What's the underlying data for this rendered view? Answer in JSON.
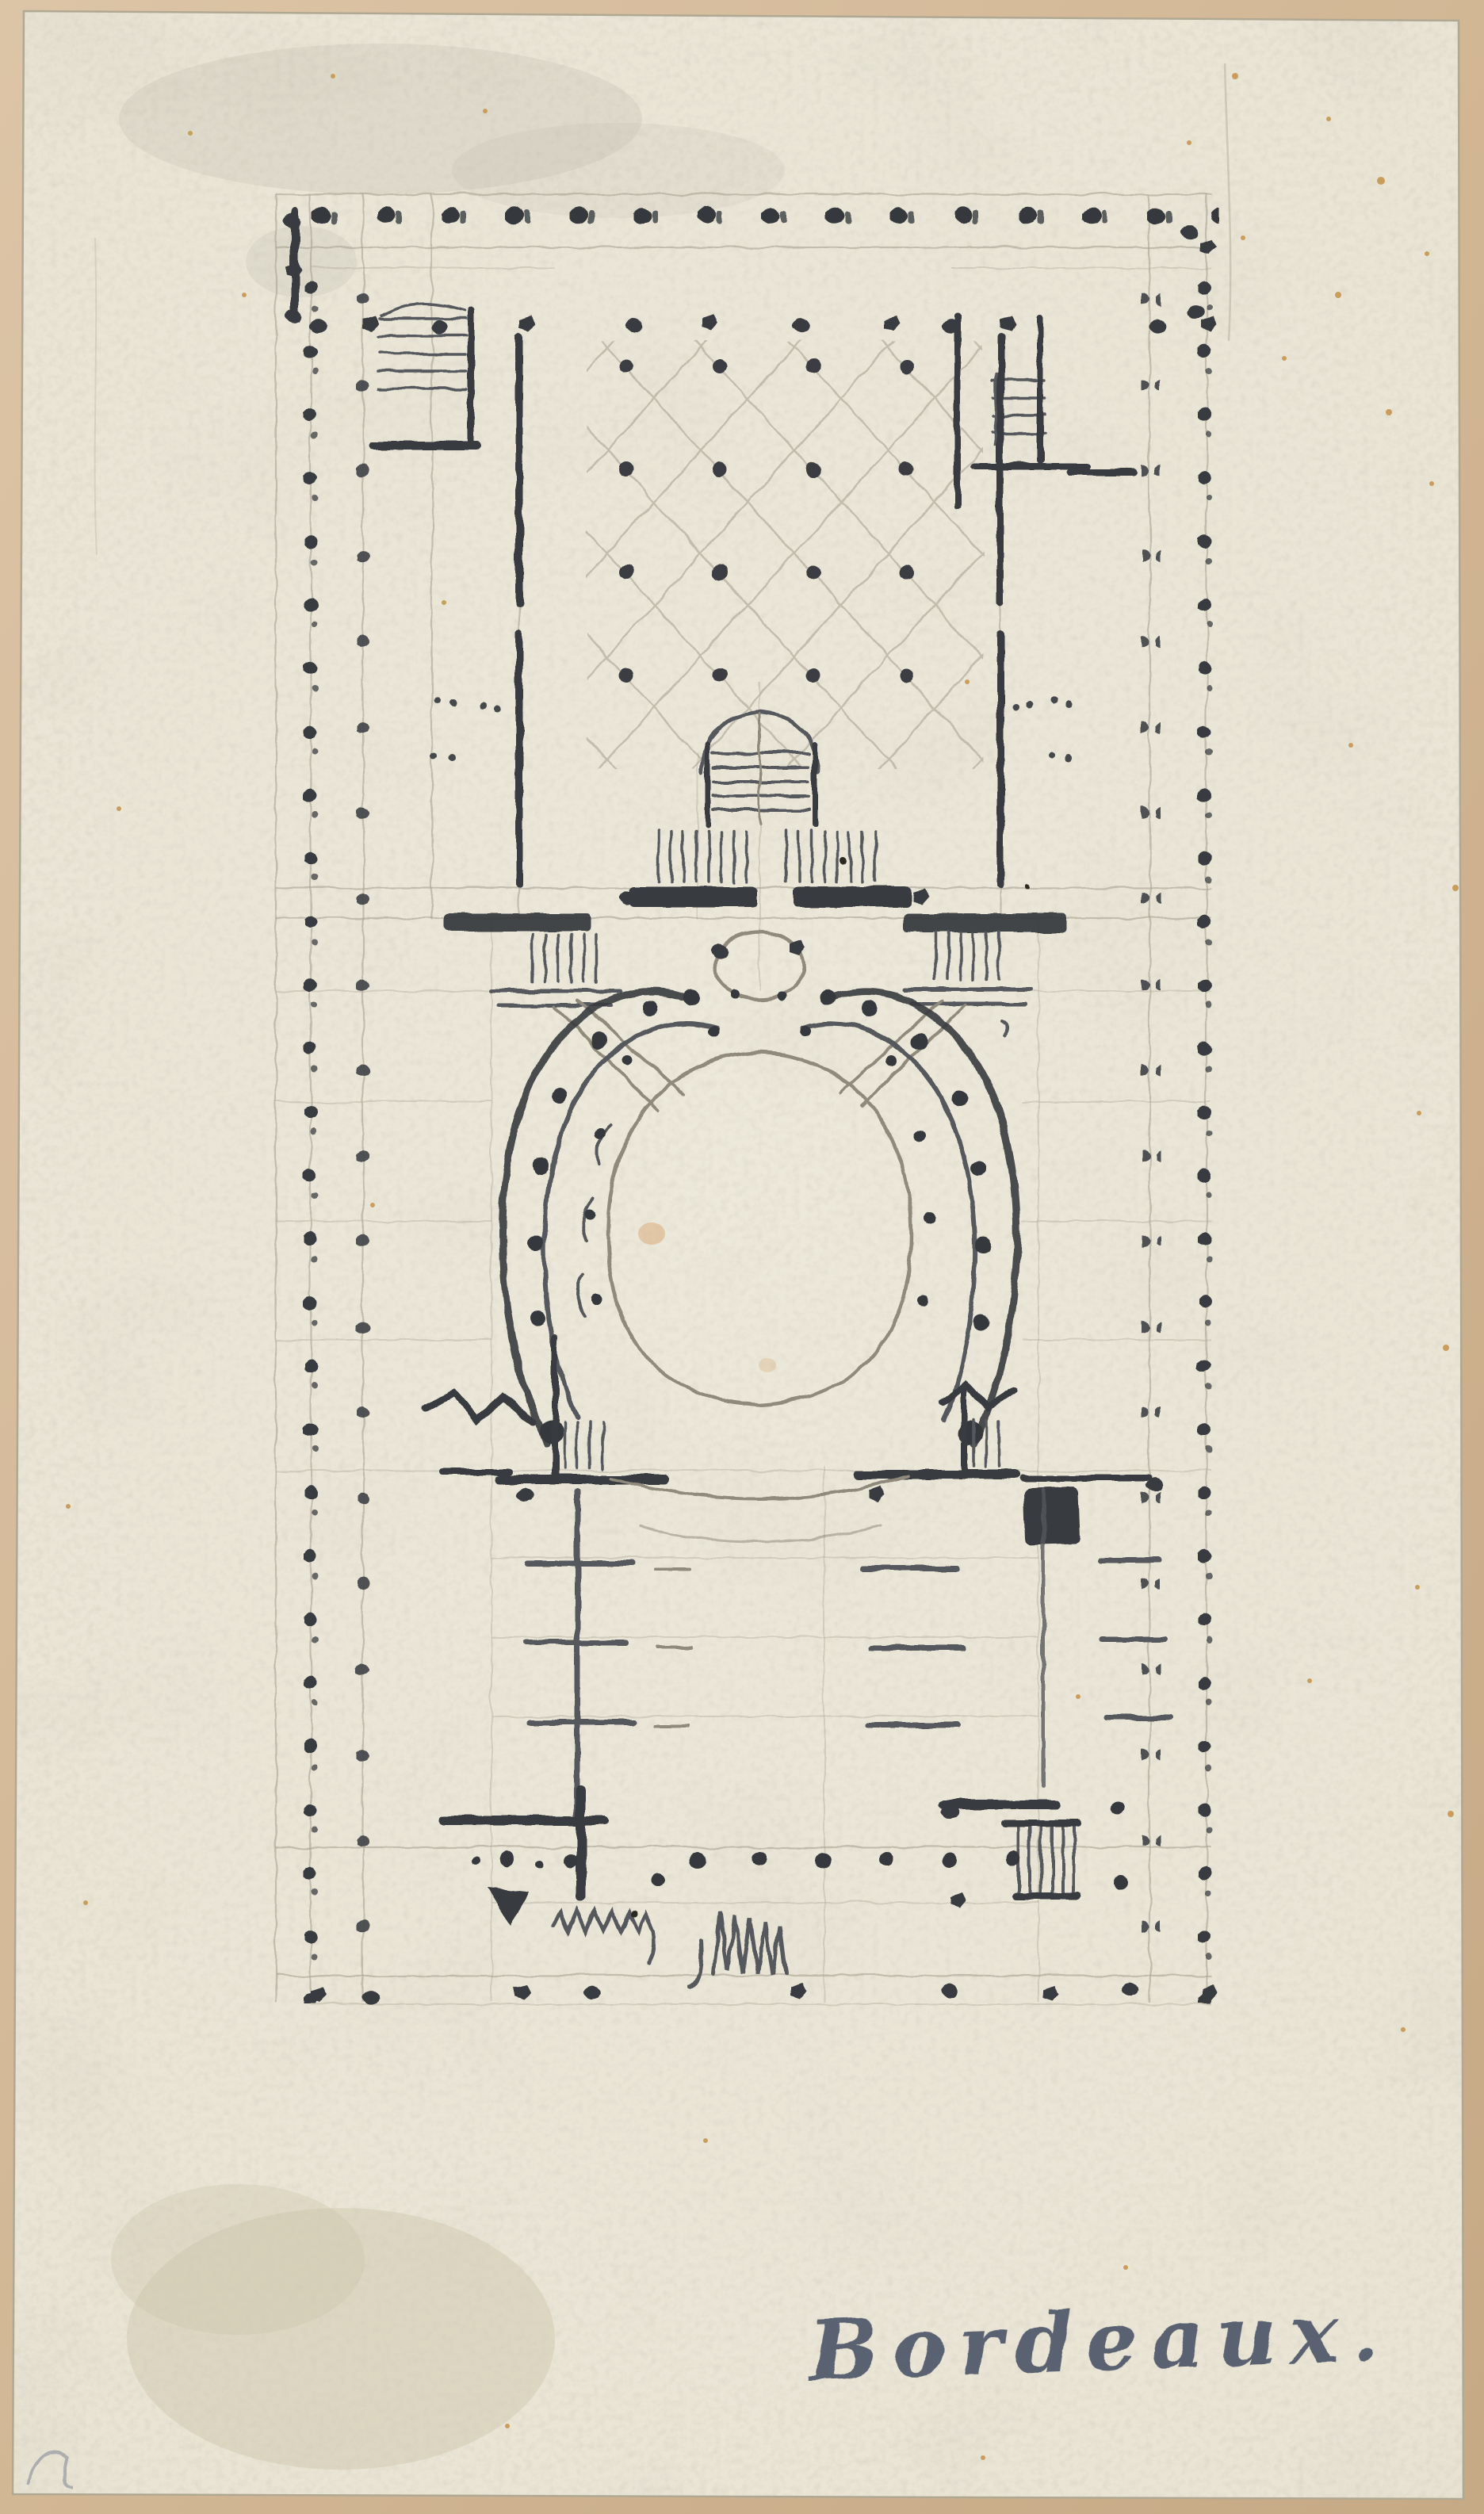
{
  "scan": {
    "mount_color": "#d2b795",
    "paper_color": "#e9e4d4",
    "graphite_dark": "#383b3f",
    "graphite_light": "#948e80",
    "foxing_color": "#c99e5d"
  },
  "drawing": {
    "type": "architectural floor plan sketch",
    "medium": "graphite on cream paper mounted on tan board",
    "features": [
      "perimeter colonnade of column marks",
      "cross-vaulted vestibule bays with dot grid",
      "corner staircases",
      "central grand staircase",
      "small oval antechamber",
      "horseshoe auditorium with ambulatory and column dots",
      "proscenium walls and stage floor hatching",
      "zigzag stair symbols at bottom"
    ]
  },
  "inscription": {
    "text": "Bordeaux.",
    "color": "#4b5468",
    "position": "lower right"
  }
}
